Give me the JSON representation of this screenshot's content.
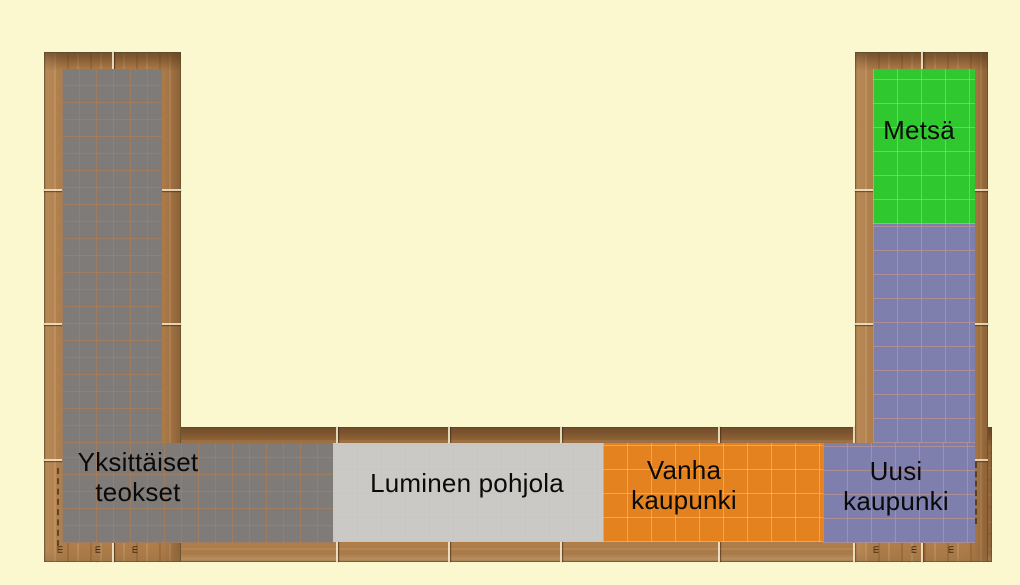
{
  "map": {
    "description_colors": {
      "background": "#FBF7CF",
      "wood": "#AE7D4A",
      "label_text": "#0A0A0A"
    },
    "zones": {
      "yksittaiset": {
        "label": "Yksittäiset\nteokset",
        "color": "#7E7B78"
      },
      "luminen": {
        "label": "Luminen pohjola",
        "color": "#CBC9C6"
      },
      "vanha": {
        "label": "Vanha\nkaupunki",
        "color": "#E3821F"
      },
      "uusi": {
        "label": "Uusi\nkaupunki",
        "color": "#7F7FAE"
      },
      "metsa": {
        "label": "Metsä",
        "color": "#2FC92F"
      }
    },
    "tick_glyph": "m"
  }
}
